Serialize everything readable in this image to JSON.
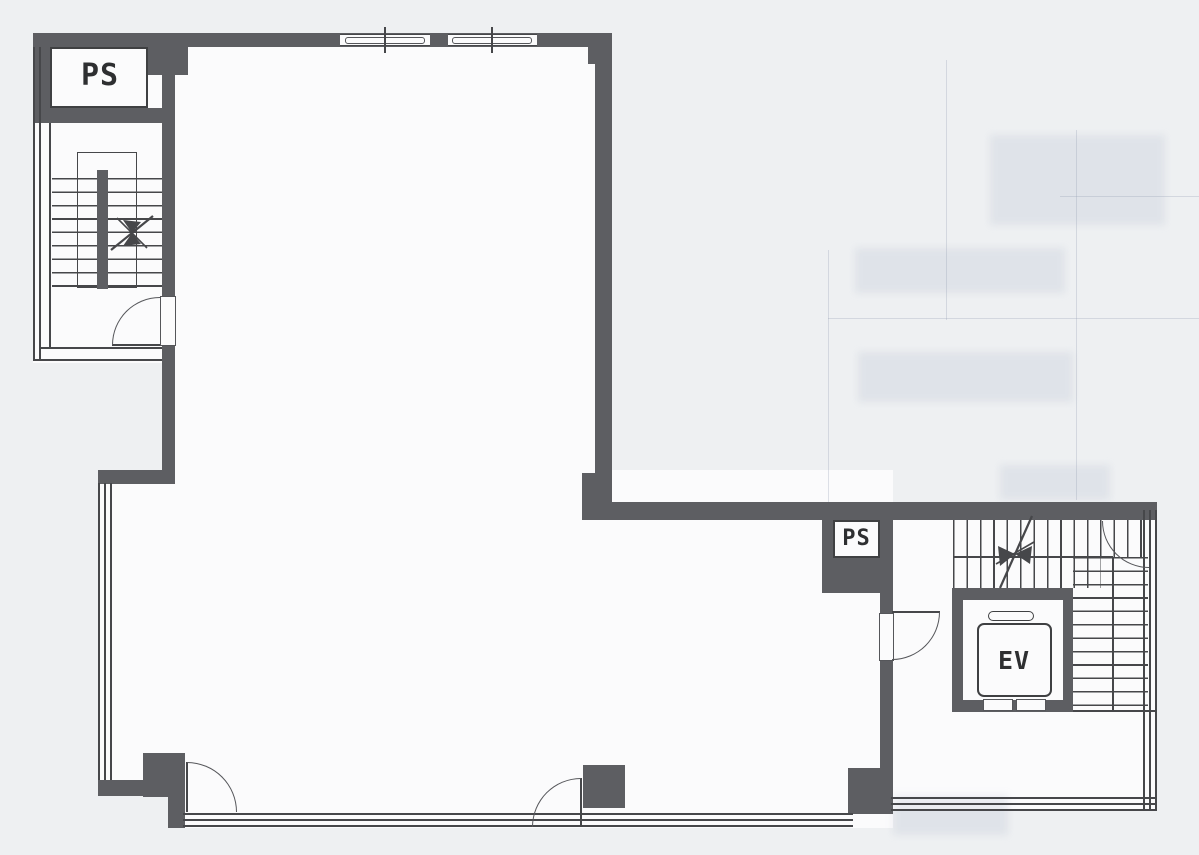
{
  "document": {
    "kind": "building-floor-plan",
    "description": "Scanned black-and-white architectural floor plan of an L-shaped office floor"
  },
  "labels": {
    "ps_upper": "PS",
    "ps_lower": "PS",
    "elevator": "EV"
  },
  "features": {
    "staircase_upper_left": "staircase with direction arrow",
    "staircase_lower_right": "staircase with direction arrow",
    "elevator_shaft": "elevator with cab and counterweight",
    "doors": 5,
    "window_walls": "triple-line glazing on west, south and east edges, window band on north wall"
  },
  "colors": {
    "wall": "#5d5e62",
    "line": "#46474a",
    "background": "#eef0f2",
    "paper": "#fbfbfc"
  }
}
